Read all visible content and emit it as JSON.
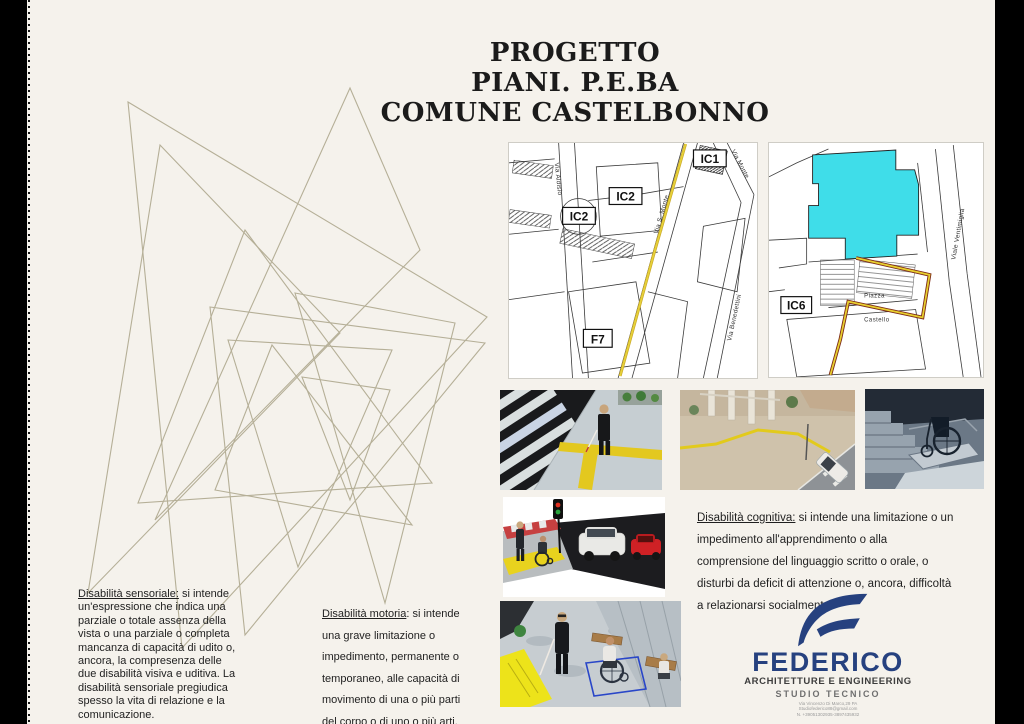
{
  "poster": {
    "title_lines": [
      "PROGETTO",
      "PIANI. P.E.BA",
      "COMUNE CASTELBONNO"
    ]
  },
  "maps": {
    "map1": {
      "labels": {
        "ic1": "IC1",
        "ic2_upper": "IC2",
        "ic2_circle": "IC2",
        "f7": "F7"
      },
      "streets": {
        "aldisio": "Via Aldisio",
        "s_monte": "Via S. Monte",
        "monte": "Via Monte",
        "benedettini": "Via Benedettini"
      }
    },
    "map2": {
      "labels": {
        "ic6": "IC6"
      },
      "streets": {
        "ventimiglia": "Viale Ventimiglia"
      },
      "places": {
        "piazza": "Piazza",
        "castello": "Castello"
      }
    }
  },
  "sections": {
    "sensoriale": {
      "lead": "Disabilità sensoriale:",
      "body": " si intende un'espressione che indica una parziale o totale assenza della vista o una parziale o completa mancanza di capacità di udito o, ancora, la compresenza delle due disabilità visiva e uditiva. La disabilità sensoriale pregiudica spesso la vita di relazione e la comunicazione."
    },
    "motoria": {
      "lead": "Disabilità motoria",
      "body": ": si intende una grave limitazione o impedimento, permanente o temporaneo, alle capacità di movimento di una o più parti del corpo o di uno o più arti."
    },
    "cognitiva": {
      "lead": "Disabilità cognitiva:",
      "body": " si intende una limitazione o un impedimento all'apprendimento o alla comprensione del linguaggio scritto o orale, o disturbi da deficit di attenzione o, ancora, difficoltà a relazionarsi socialmente."
    }
  },
  "logo": {
    "name": "FEDERICO",
    "tagline": "ARCHITETTURE E ENGINEERING",
    "subtitle": "STUDIO TECNICO",
    "address": "Via Vincenzo Di Marco,29 PA",
    "email": "Studiofederico88@gmail.com",
    "phone": "N. +39051302935-3897435932",
    "brand_color": "#26417f"
  },
  "colors": {
    "background": "#f5f2ec",
    "film_strip": "#000000",
    "sketch_lines": "#b5af97",
    "map_route_yellow": "#e7d23a",
    "map_building_cyan": "#3fdde9",
    "tactile_yellow": "#e8d21e"
  }
}
